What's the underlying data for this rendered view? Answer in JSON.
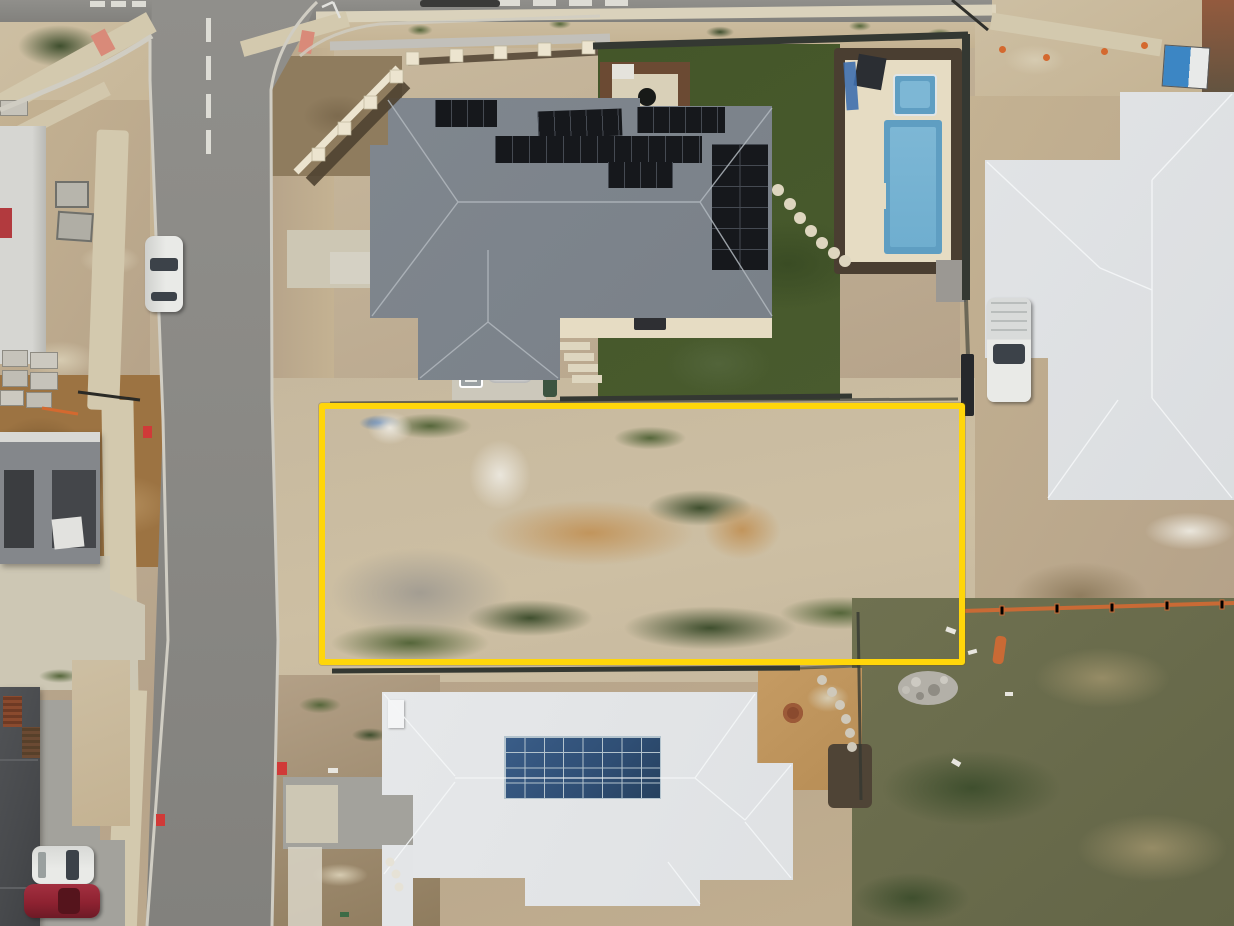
{
  "meta": {
    "description": "Aerial drone photograph of a new suburban estate: a vacant dirt building lot outlined with a yellow rectangle, bordered by a street on the left, a grey-roofed house with black solar panels and a swimming pool above, a white-roofed house with a blue solar array below, and partially built houses around it.",
    "width": 1234,
    "height": 926
  },
  "colors": {
    "asphalt": "#908f8b",
    "asphalt_dark": "#82817d",
    "curb": "#d0cdc3",
    "road_marking": "#dddcd5",
    "path": "#d3c9ae",
    "path_light": "#ded6bf",
    "concrete_pad": "#d9d5c7",
    "aggregate": "#a3a29c",
    "aggregate_light": "#cdc7b4",
    "dirt": "#b5a289",
    "dirt_light": "#cdbfa3",
    "dirt_sand": "#c4b292",
    "dirt_pale": "#d6cbb1",
    "dirt_orange": "#9c7342",
    "dirt_brown": "#8f7c5e",
    "lot_base": "#c6b89e",
    "lot_gray": "#a39d92",
    "sand_pile": "#c2955c",
    "chalk": "#eae6dc",
    "weed_green": "#55663a",
    "weed_dark": "#3f4f2e",
    "lawn": "#445629",
    "lawn_dark": "#3a4c24",
    "field_green": "#6f7150",
    "field_brown": "#968c66",
    "roof_gray": "#7b828a",
    "ridge_gray": "#b2b8be",
    "roof_white": "#e3e5e7",
    "ridge_white": "#f4f6f7",
    "roof_dark": "#47494c",
    "roof_dark_line": "#5e6063",
    "rust": "#8a4a2e",
    "timber": "#6b4a33",
    "timber_dark": "#4f4231",
    "solar_black": "#16181c",
    "solar_grid": "#454a52",
    "solar_blue": "#2f4e74",
    "solar_blue_grid": "#b3c3cd",
    "pool_paving": "#e6dcc3",
    "pool_water": "#5f9ec2",
    "pool_water_light": "#7db7d5",
    "pool_soil": "#4a3e31",
    "fence_dark": "#343832",
    "wall_gray": "#c2c0ba",
    "limestone": "#ece4cf",
    "car_white": "#e9eae7",
    "glass": "#3c4249",
    "car_red": "#8e2231",
    "car_red_dark": "#55141c",
    "marker_red": "#d03a38",
    "ramp_salmon": "#d98a79",
    "portaloo_blue": "#3c86c4",
    "portaloo_white": "#e8eae9",
    "cone_orange": "#d4692f",
    "silt_orange": "#c96a35",
    "bin_green": "#3c5440",
    "tank_white": "#eceded",
    "tarp_blue": "#3f6fae",
    "shed_dark": "#2b2e33",
    "stone": "#b3b0a8",
    "highlight": "#FFD60A"
  },
  "objects": {
    "lot": {
      "label": "Vacant land parcel outlined in yellow"
    },
    "street": {
      "label": "Suburban street with dashed centre line and kerbs"
    },
    "top_house": {
      "label": "House with dark grey hip roof and black rooftop solar panels"
    },
    "backyard": {
      "label": "Rear lawn with stepping stones, pergola fire pit and pool"
    },
    "pool": {
      "label": "Swimming pool and spa with cream paving"
    },
    "right_house": {
      "label": "House with light grey/white roof"
    },
    "bottom_house": {
      "label": "House with white roof and blue solar array"
    },
    "corner_house": {
      "label": "Dark-roofed house at bottom-left with driveway"
    },
    "left_house": {
      "label": "House under construction at left edge"
    },
    "street_car": {
      "label": "White car parked on street"
    },
    "driveway_car_white": {
      "label": "White car in driveway"
    },
    "driveway_car_red": {
      "label": "Red car in driveway"
    },
    "ute": {
      "label": "White utility vehicle parked beside right house"
    },
    "portaloo": {
      "label": "Portable toilet on construction verge"
    },
    "silt_fence": {
      "label": "Orange silt fence"
    },
    "rubble": {
      "label": "Pile of paving rubble"
    },
    "retaining_wall": {
      "label": "Limestone retaining wall and timber fence"
    },
    "solar_top": {
      "label": "Black solar panel arrays"
    },
    "solar_bottom": {
      "label": "Blue solar panel array"
    }
  }
}
